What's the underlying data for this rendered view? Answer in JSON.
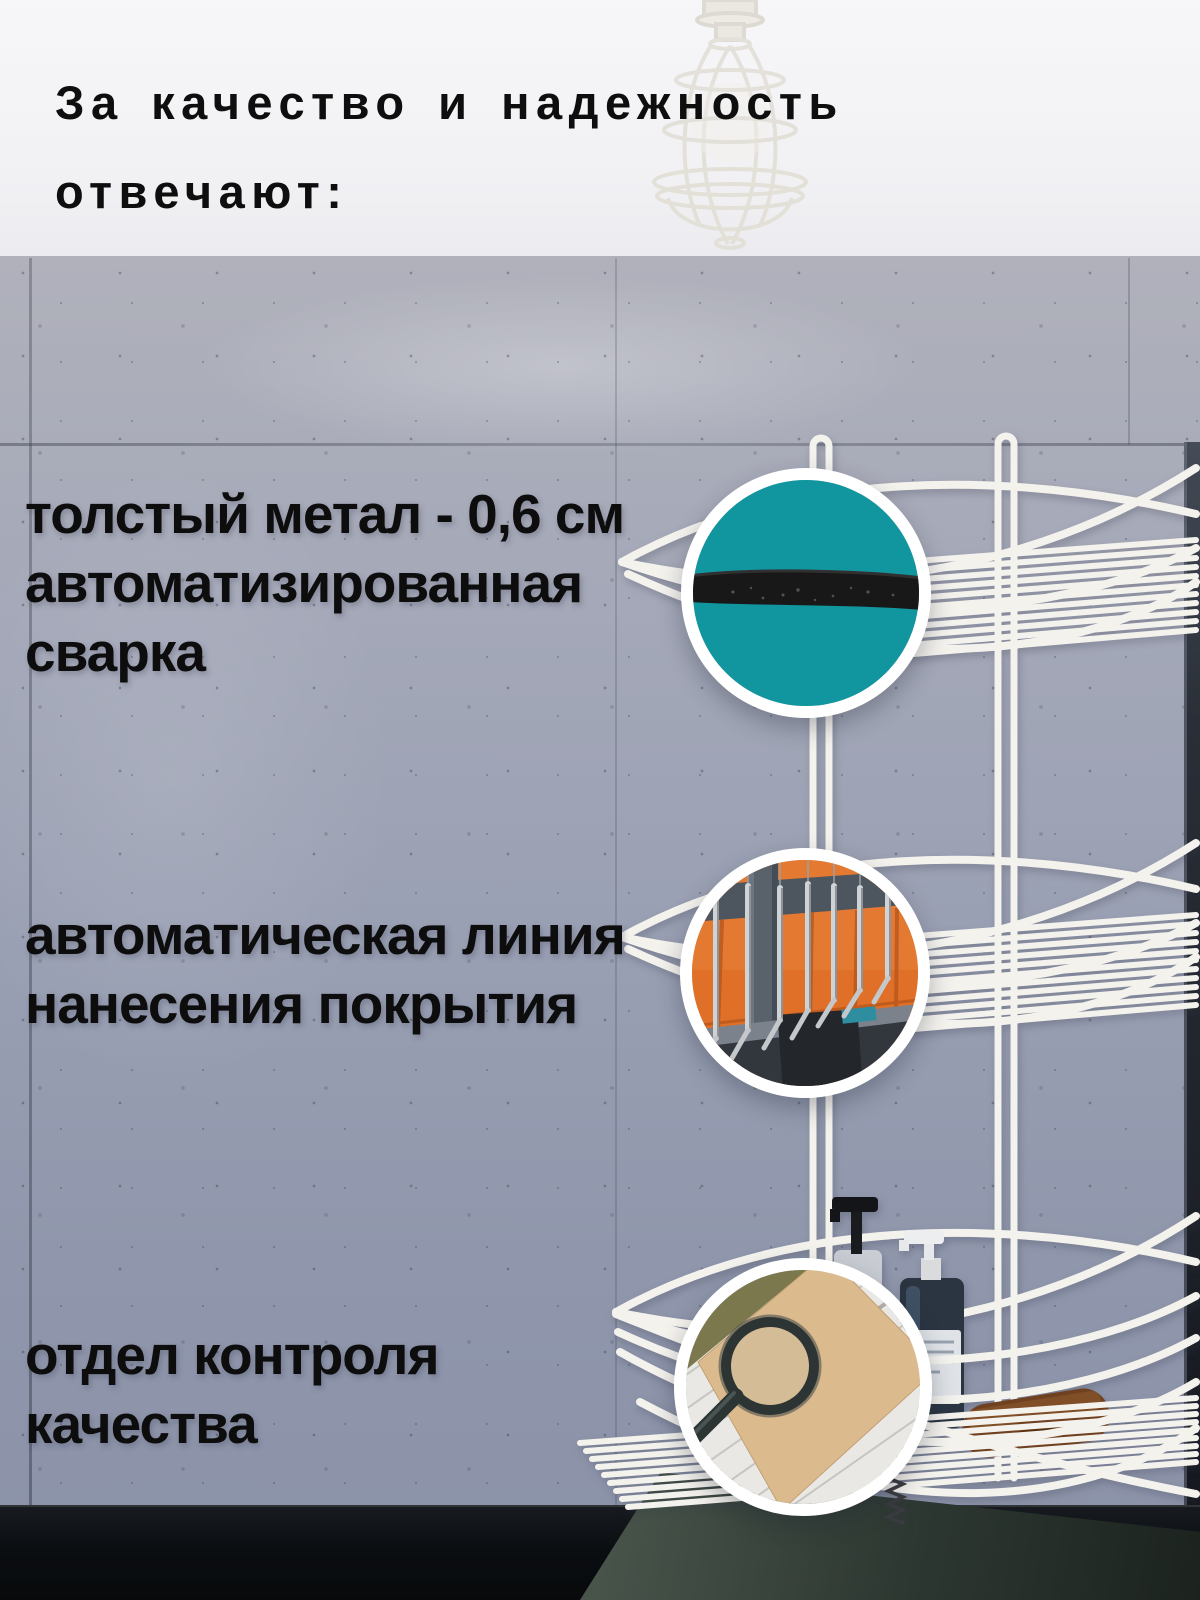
{
  "banner": {
    "title_line1": "За качество и надежность",
    "title_line2": "отвечают:"
  },
  "features": [
    {
      "callout": "wire-rod-thickness-closeup",
      "lines": [
        "толстый метал - 0,6 см",
        "автоматизированная",
        "сварка"
      ]
    },
    {
      "callout": "powder-coating-line-photo",
      "lines": [
        "автоматическая линия",
        "нанесения покрытия"
      ]
    },
    {
      "callout": "quality-control-magnifier-photo",
      "lines": [
        "отдел контроля",
        "качества"
      ]
    }
  ],
  "colors": {
    "accent_teal": "#1196a0",
    "banner_bg": "#f4f4f6",
    "text": "#0d0d0d",
    "wire_white": "#f4f2ed",
    "counter_black": "#0b0e11",
    "coating_orange": "#e07028",
    "kraft": "#d7b488"
  }
}
